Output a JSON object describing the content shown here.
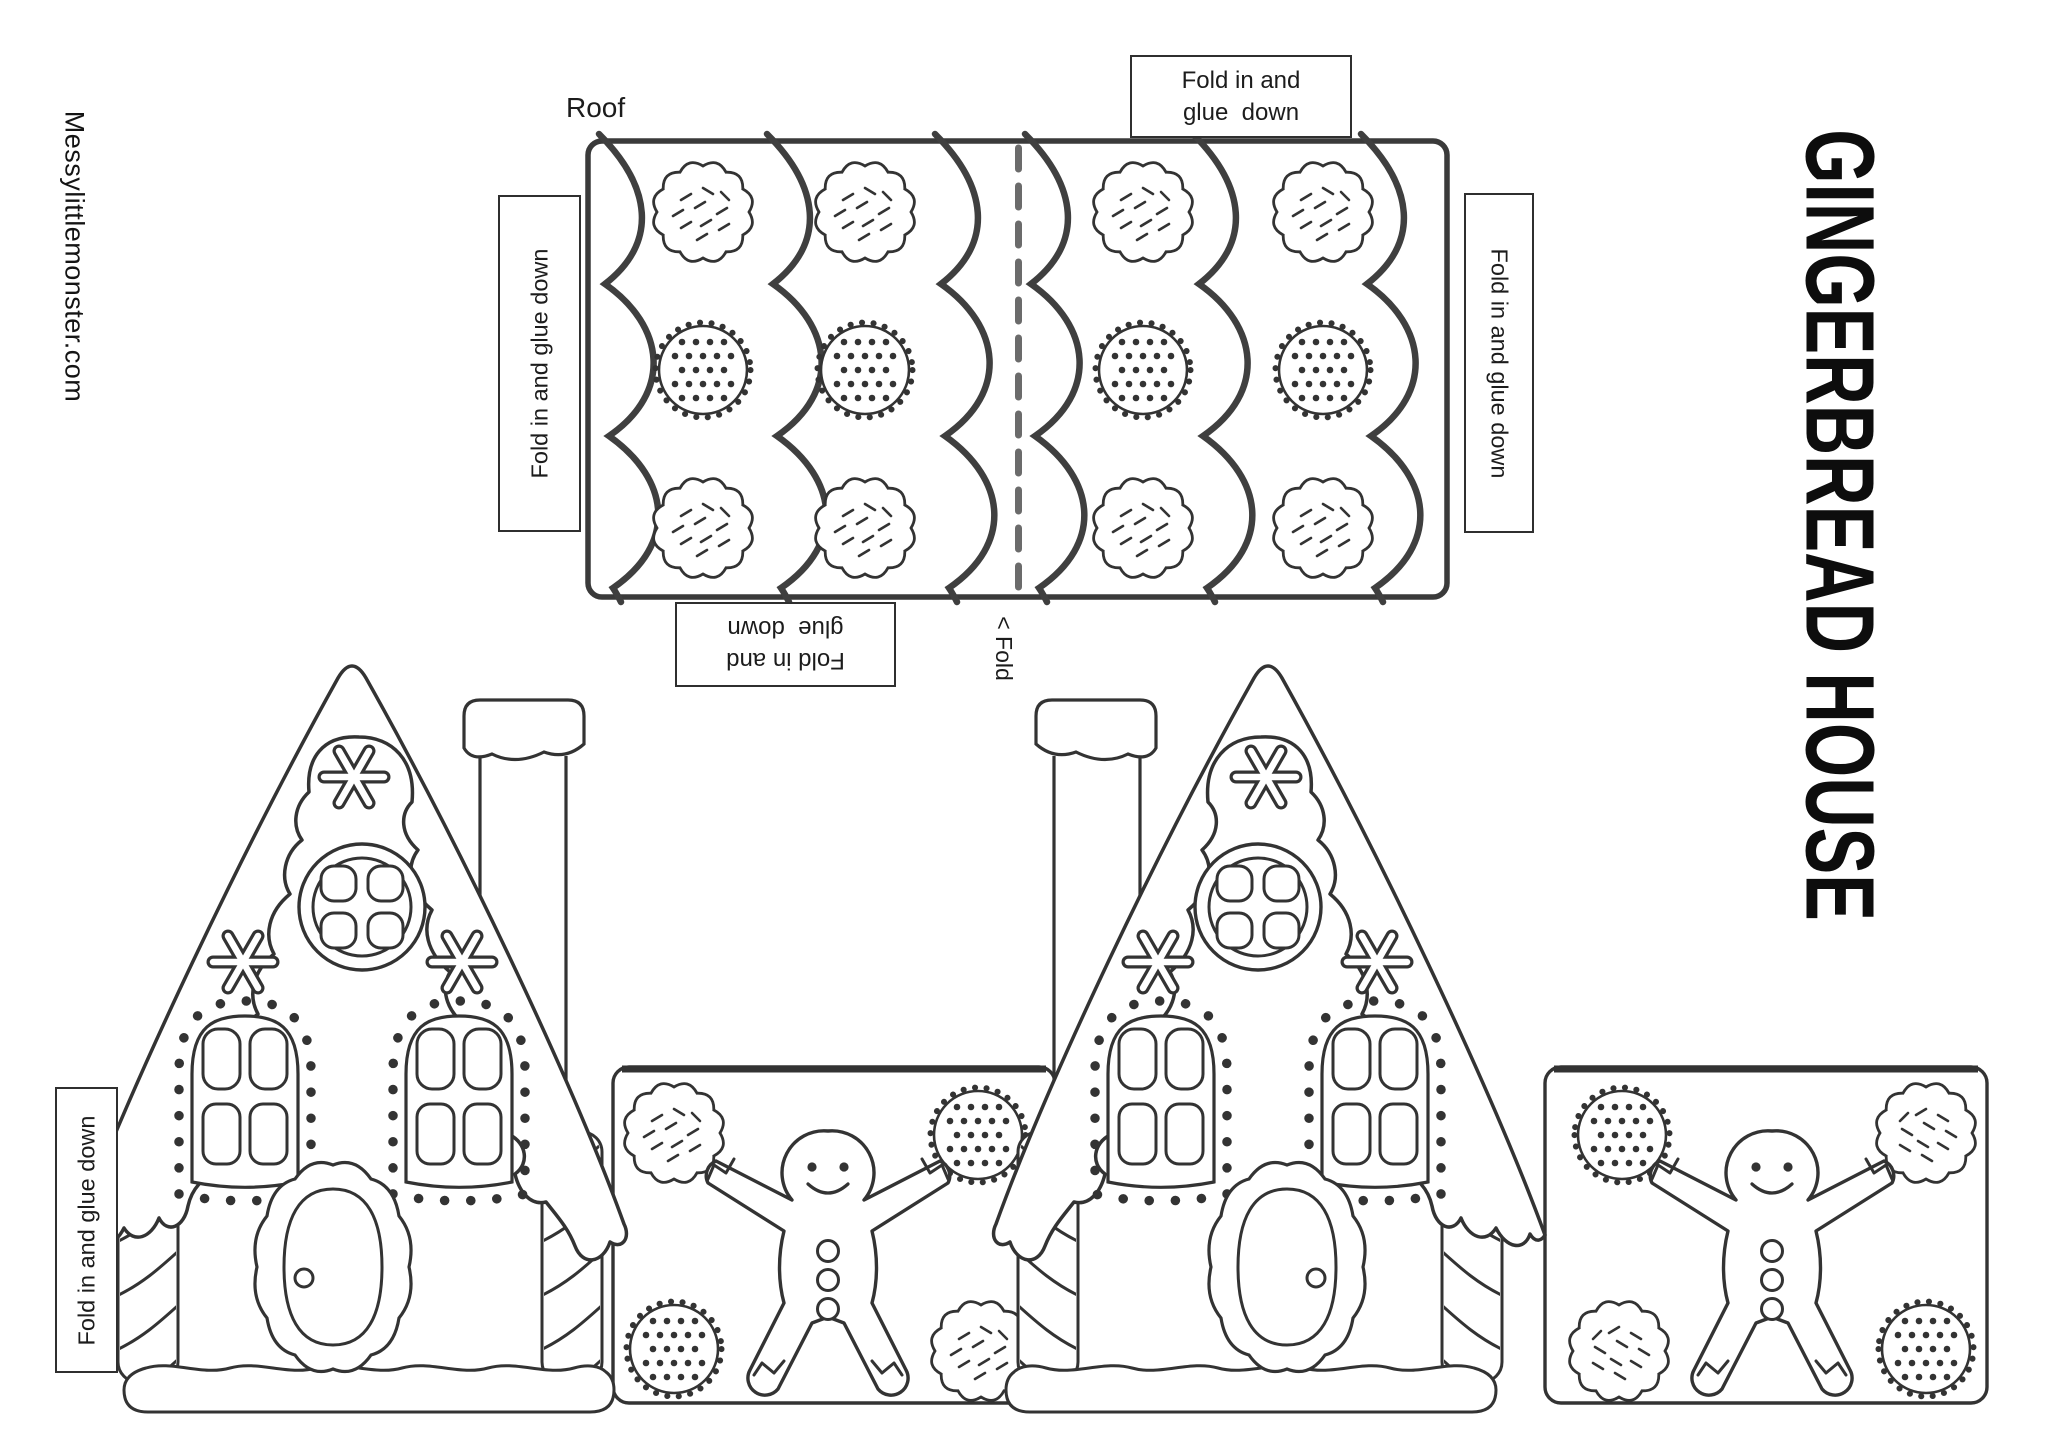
{
  "page": {
    "brand": "Messylittlemonster.com",
    "title": "GINGERBREAD HOUSE"
  },
  "roof": {
    "label": "Roof",
    "fold_marker": "< Fold"
  },
  "flaps": {
    "top": {
      "line1": "Fold in and",
      "line2": "glue  down"
    },
    "roof_left": "Fold in and glue  down",
    "roof_right": "Fold in and glue  down",
    "bottom": {
      "line1": "Fold in and",
      "line2": "glue  down"
    },
    "house_left": "Fold in and glue  down"
  },
  "colors": {
    "ink": "#333333",
    "border": "#3a3a3a",
    "fold_dash": "#6b6b6b"
  }
}
